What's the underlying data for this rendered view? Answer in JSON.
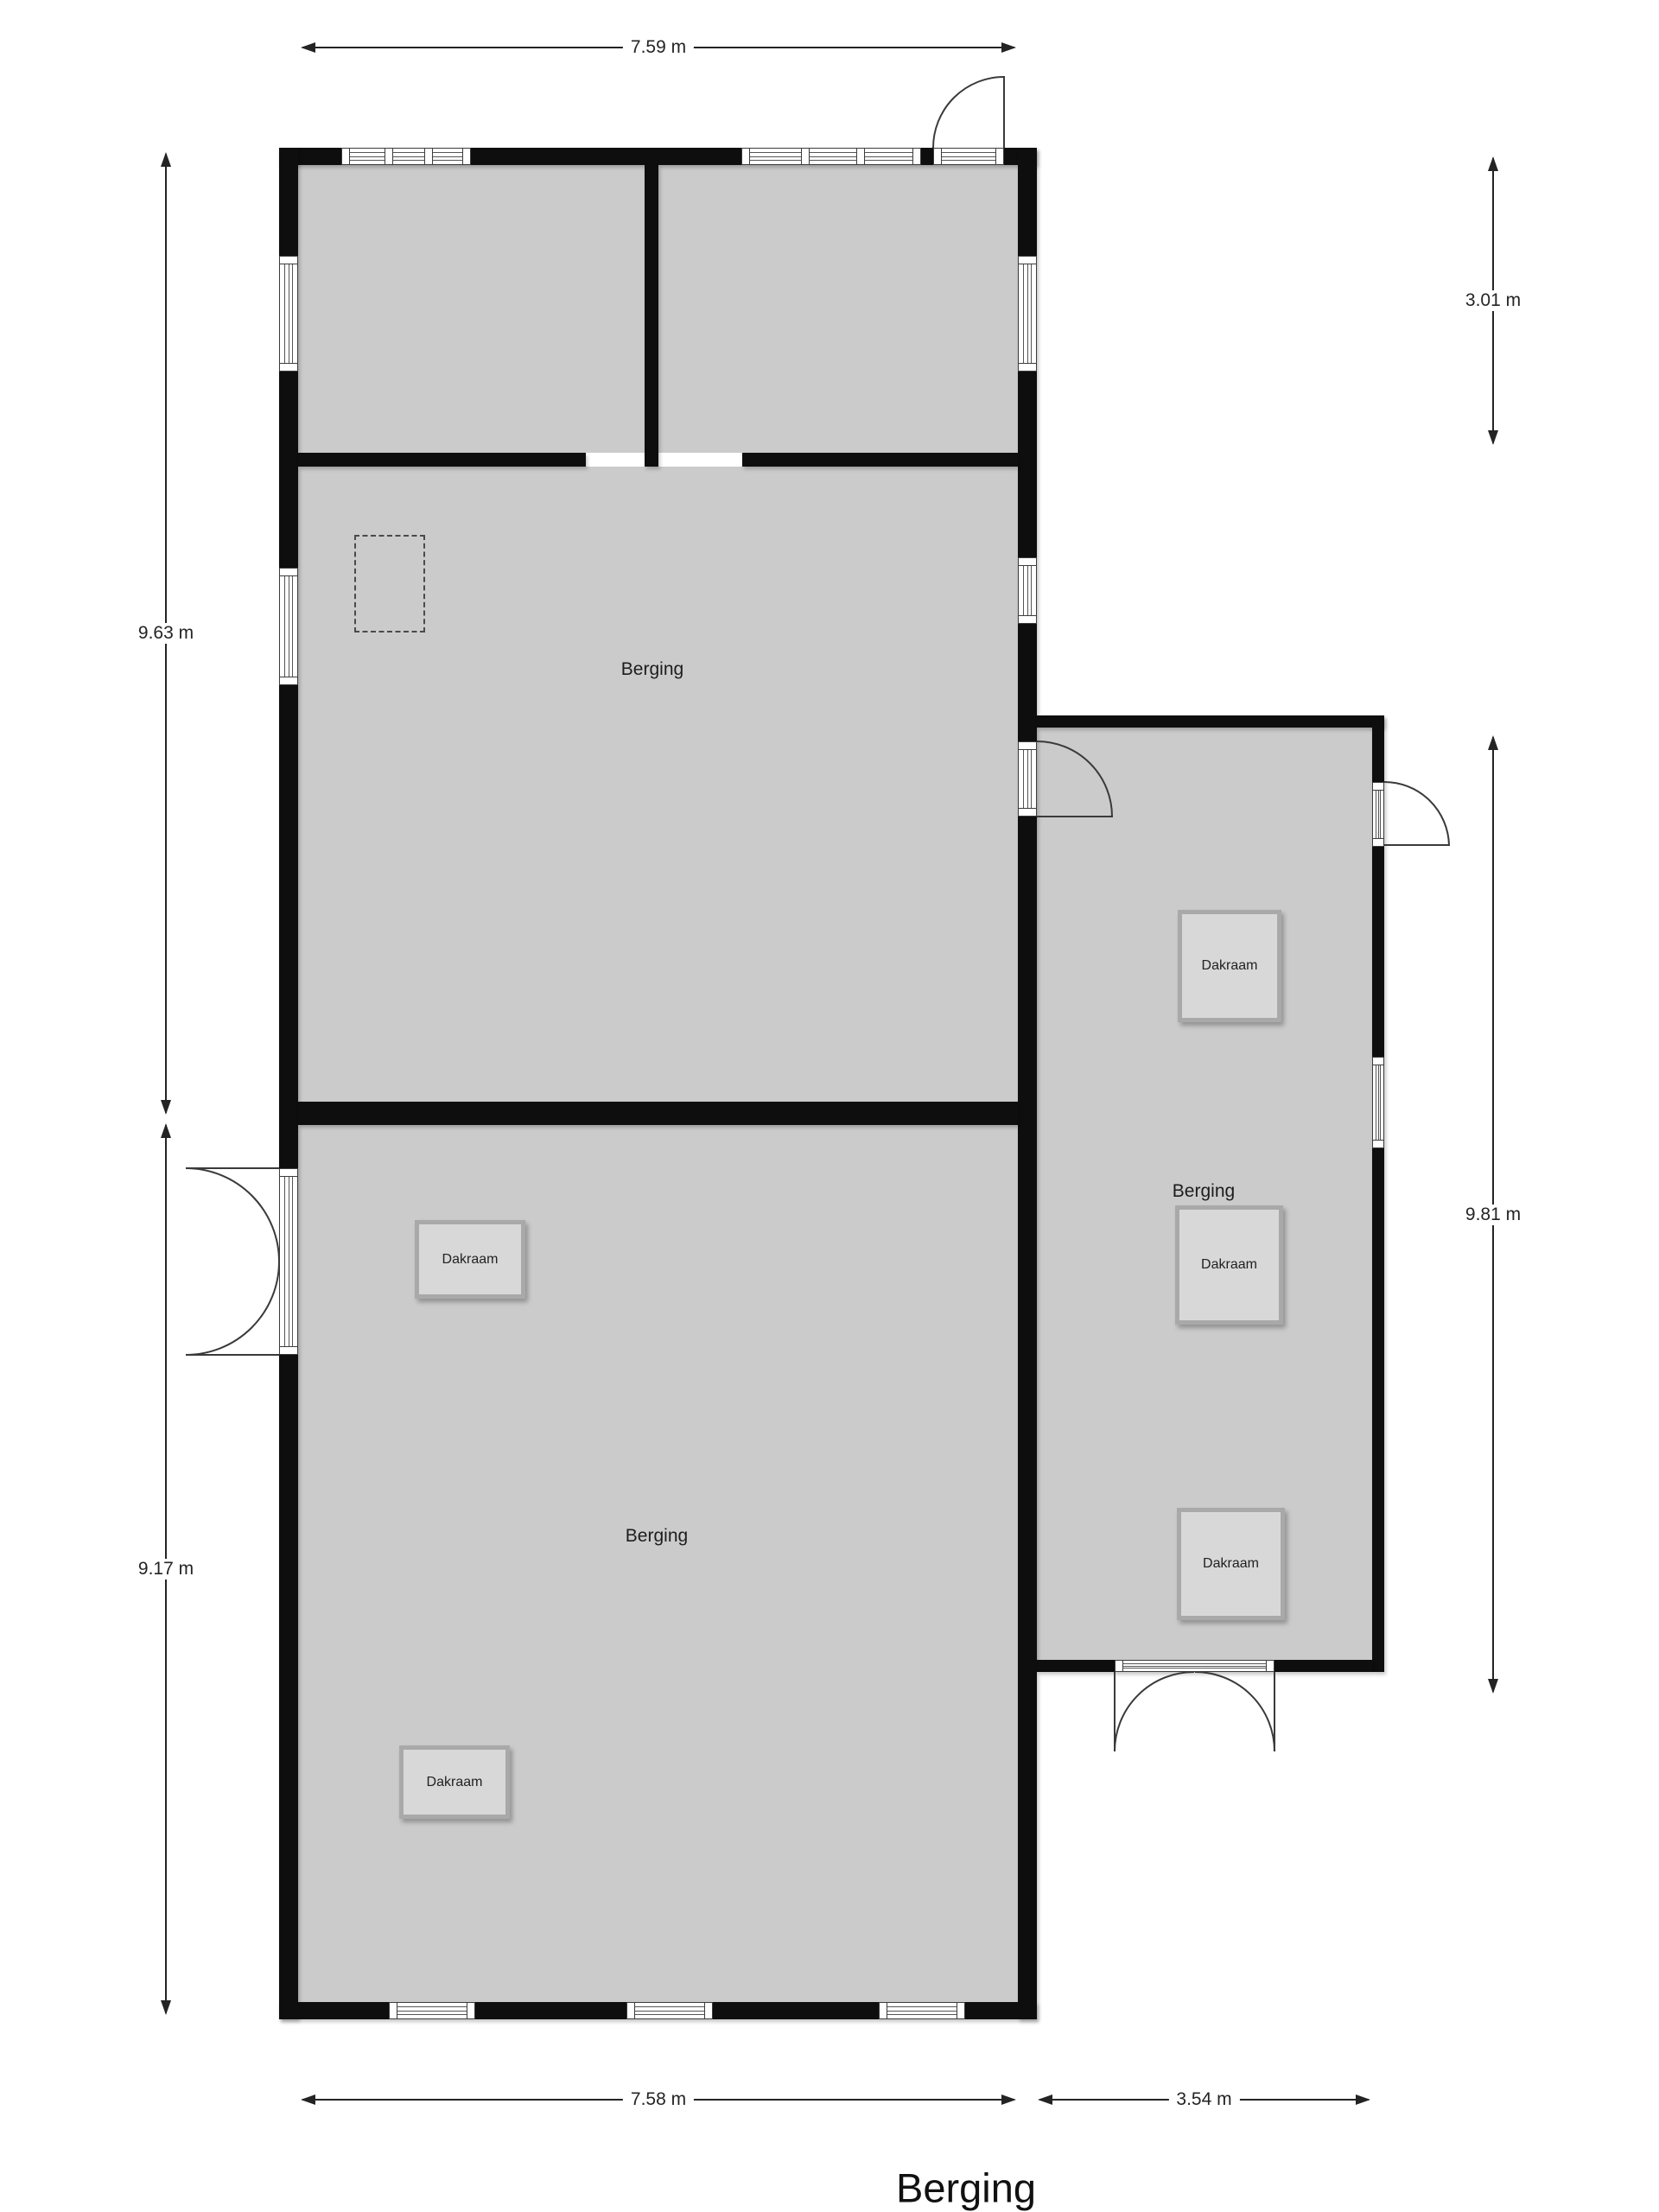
{
  "title": "Berging",
  "rooms": {
    "top_label": "Berging",
    "bottom_label": "Berging",
    "annex_label": "Berging"
  },
  "skylight_label": "Dakraam",
  "dimensions": {
    "top_width": "7.59 m",
    "upper_height": "9.63 m",
    "lower_height": "9.17 m",
    "annex_upper_height": "3.01 m",
    "annex_height": "9.81 m",
    "bottom_width": "7.58 m",
    "annex_width": "3.54 m"
  },
  "colors": {
    "wall": "#0e0e0e",
    "room_fill": "#cbcbcb",
    "skylight_fill": "#d8d8d8",
    "skylight_border": "#a9a9a9",
    "dimension_line": "#242424"
  }
}
